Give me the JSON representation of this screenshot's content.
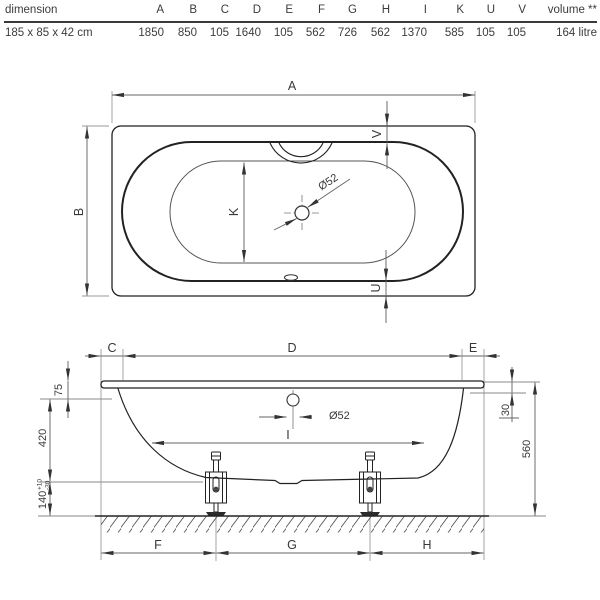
{
  "table": {
    "header": [
      "dimension",
      "A",
      "B",
      "C",
      "D",
      "E",
      "F",
      "G",
      "H",
      "I",
      "K",
      "U",
      "V",
      "volume **"
    ],
    "values": [
      "185 x 85 x 42 cm",
      "1850",
      "850",
      "105",
      "1640",
      "105",
      "562",
      "726",
      "562",
      "1370",
      "585",
      "105",
      "105",
      "164 litre"
    ]
  },
  "top_view": {
    "length_label": "A",
    "width_label": "B",
    "inner_width_label": "K",
    "rim_bottom_label": "U",
    "rim_top_label": "V",
    "drain_label": "Ø52"
  },
  "side_view": {
    "left_end_label": "C",
    "rim_length_label": "D",
    "right_end_label": "E",
    "foot_left_label": "F",
    "feet_span_label": "G",
    "foot_right_label": "H",
    "base_length_label": "I",
    "drain_label": "Ø52",
    "rim_drop_label": "75",
    "depth_label": "420",
    "clearance_label": "140",
    "clearance_tol_plus": "+10",
    "clearance_tol_minus": "-30",
    "overflow_drop_label": "30",
    "height_label": "560"
  },
  "colors": {
    "object_line": "#222222",
    "dimension_line": "#666666",
    "extension_line": "#9a9a9a",
    "text": "#3a3a3a",
    "background": "#ffffff"
  }
}
